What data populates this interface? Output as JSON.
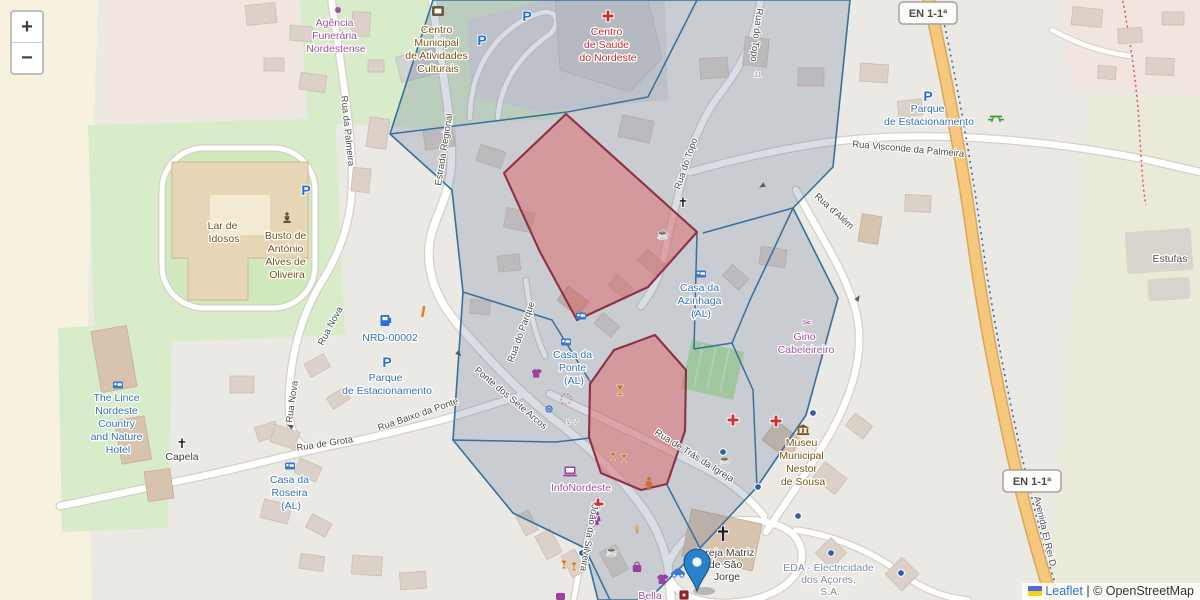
{
  "colors": {
    "overlay-blue-stroke": "#36709f",
    "overlay-blue-fill": "#5a7096",
    "overlay-red-stroke": "#8e3047",
    "overlay-red-fill": "#e05c5c",
    "marker-blue": "#2a81cb",
    "road-orange": "#f6c87e",
    "road-orange-casing": "#d9a851",
    "label-blue": "#3273b5",
    "label-purple": "#a152a3",
    "label-red": "#c22f2f",
    "label-brown": "#7a5213",
    "label-gray": "#4c4c4a",
    "label-power": "#7d8ca3",
    "parking-blue": "#2a6fce",
    "street-casing": "#d6d0c7"
  },
  "controls": {
    "zoom_in": "+",
    "zoom_out": "−"
  },
  "attribution": {
    "leaflet_label": "Leaflet",
    "separator": "|",
    "osm_label": "© OpenStreetMap"
  },
  "shields": {
    "en_top": "EN 1-1ª",
    "en_bottom": "EN 1-1ª"
  },
  "streets": {
    "rua_da_palmeira": "Rua da Palmeira",
    "estrada_regional": "Estrada Regional",
    "rua_do_topo_a": "Rua do Topo",
    "rua_do_topo_b": "Rua do Topo",
    "rua_visconde": "Rua Visconde da Palmeira",
    "rua_dalem": "Rua d'Além",
    "rua_nova_a": "Rua Nova",
    "rua_nova_b": "Rua Nova",
    "rua_de_grota": "Rua de Grota",
    "rua_baixo_da_ponte": "Rua Baixo da Ponte",
    "ponte_sete_arcos": "Ponte dos Sete Arcos",
    "rua_do_parque": "Rua do Parque",
    "rua_tras_igreja": "Rua de Trás da Igreja",
    "avenida": "Avenida El Rei D",
    "silveira": "João da Silveira",
    "house_11": "11"
  },
  "pois": {
    "agencia": {
      "l1": "Agência",
      "l2": "Funerária",
      "l3": "Nordestense"
    },
    "centro_municipal": {
      "l1": "Centro",
      "l2": "Municipal",
      "l3": "de Atividades",
      "l4": "Culturais"
    },
    "centro_saude": {
      "l1": "Centro",
      "l2": "de Saúde",
      "l3": "do Nordeste"
    },
    "parque_top": {
      "l1": "Parque",
      "l2": "de Estacionamento"
    },
    "lar": {
      "l1": "Lar de",
      "l2": "Idosos"
    },
    "busto": {
      "l1": "Busto de",
      "l2": "António",
      "l3": "Alves de",
      "l4": "Oliveira"
    },
    "nrd": {
      "l1": "NRD-00002"
    },
    "parque_left": {
      "l1": "Parque",
      "l2": "de Estacionamento"
    },
    "casa_ponte": {
      "l1": "Casa da",
      "l2": "Ponte",
      "l3": "(AL)"
    },
    "casa_azinhaga": {
      "l1": "Casa da",
      "l2": "Azinhaga",
      "l3": "(AL)"
    },
    "gino": {
      "l1": "Gino",
      "l2": "Cabeleireiro"
    },
    "lince": {
      "l1": "The Lince",
      "l2": "Nordeste",
      "l3": "Country",
      "l4": "and Nature",
      "l5": "Hotel"
    },
    "capela": {
      "l1": "Capela"
    },
    "roseira": {
      "l1": "Casa da",
      "l2": "Roseira",
      "l3": "(AL)"
    },
    "infonordeste": {
      "l1": "InfoNordeste"
    },
    "museu": {
      "l1": "Museu",
      "l2": "Municipal",
      "l3": "Nestor",
      "l4": "de Sousa"
    },
    "igreja": {
      "l1": "Igreja Matriz",
      "l2": "de São",
      "l3": "Jorge"
    },
    "eda": {
      "l1": "EDA - Electricidade",
      "l2": "dos Açores,",
      "l3": "S.A."
    },
    "bella": {
      "l1": "Bella"
    },
    "estufas": {
      "l1": "Estufas"
    }
  },
  "icons": {
    "parking_glyph": "P",
    "church_cross": "✝",
    "scissors_glyph": "✂",
    "cafe_glyph": "☕",
    "toilets_glyph": "♀♂"
  }
}
